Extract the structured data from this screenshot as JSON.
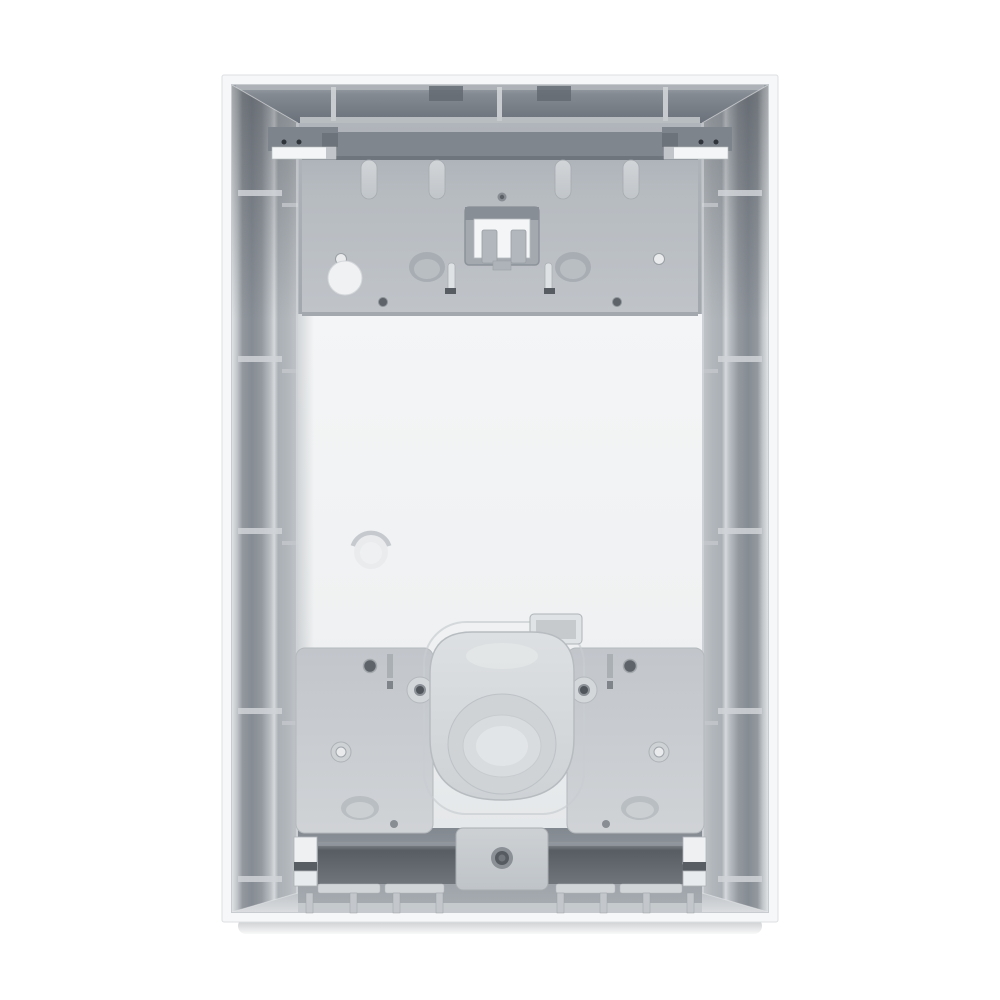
{
  "image": {
    "kind": "product-photo",
    "subject": "flush-mount-installation-box-interior-view",
    "text_content": "none"
  },
  "colors": {
    "bg": "#ffffff",
    "frame": "#f6f7f8",
    "frame_border": "#dcdfe2",
    "wall_top": "#848a91",
    "wall_side": "#92989e",
    "wall_rib": "#d0d4d7",
    "ledge": "#c9cdd1",
    "cavity": "#9ea4aa",
    "panel": "#f0f2f3",
    "plate": "#b8bdc2",
    "plate_edge": "#80868d",
    "clip": "#7e848b",
    "clip_highlight": "#f3f5f6",
    "tab": "#ccd0d4",
    "window": "#f3f5f6",
    "hole_dark": "#5d6369",
    "knockout_oval": "#a7adb3",
    "knockout_circle": "#eff1f3",
    "bottom_plate": "#c8ccd0",
    "grommet": "#d7dadd",
    "grommet_ring": "#cfd3d6",
    "rail": "#5a6066",
    "bracket": "#c7cbcf",
    "strip": "#d2d5d8",
    "peg": "#c3c7cb",
    "floor": "#979da3",
    "band": "#c9cdd0",
    "shadow": "#9aa0a6"
  }
}
